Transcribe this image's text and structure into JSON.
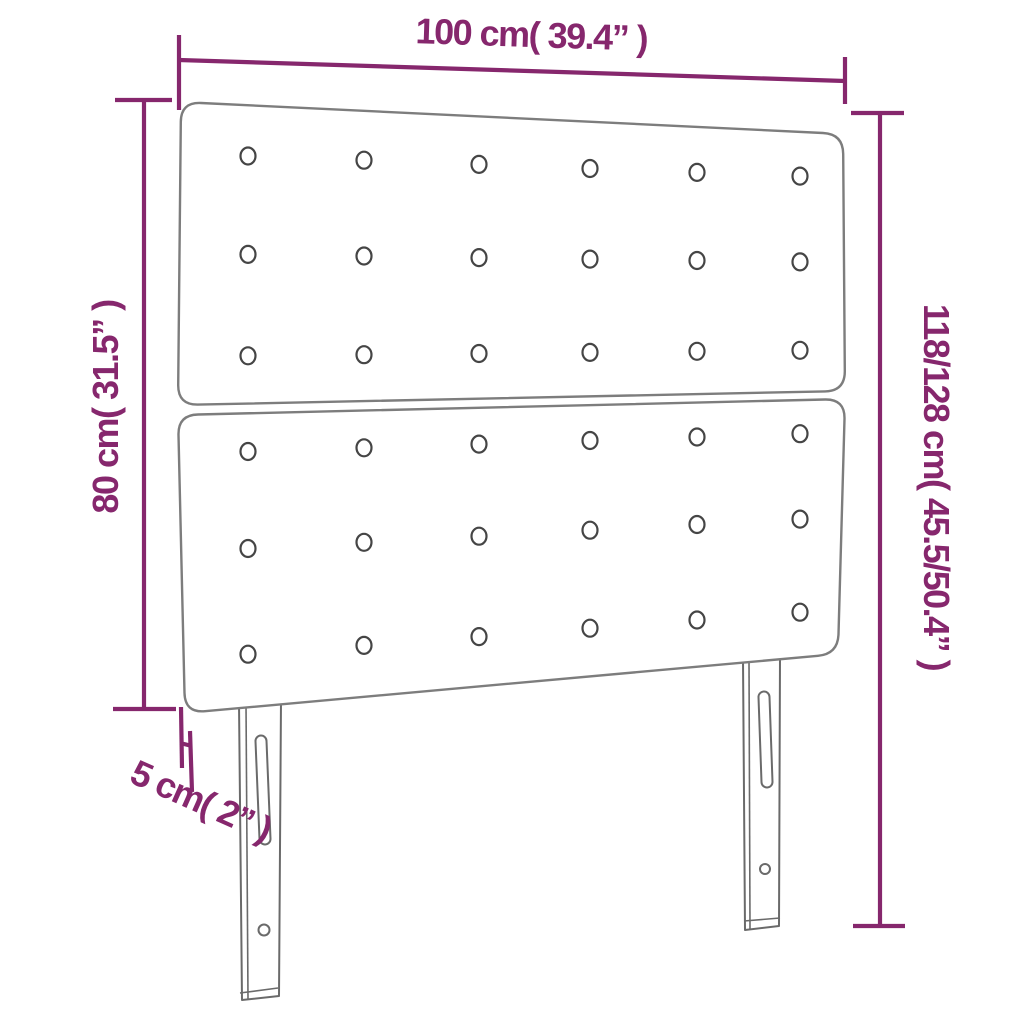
{
  "page": {
    "kind": "product-dimension-diagram",
    "background": "#ffffff"
  },
  "colors": {
    "dimension": "#86276d",
    "panel_outline": "#7d7d7d",
    "leg_outline": "#6a6a6a",
    "button_outline": "#454545"
  },
  "product": {
    "name": "headboard",
    "panel_count": 2,
    "button_rows_per_panel": 3,
    "button_columns": 6,
    "leg_count": 2
  },
  "dimensions": {
    "width": {
      "label": "100 cm( 39.4” )",
      "value_cm": "100",
      "value_in": "39.4"
    },
    "headboard_height": {
      "label": "80 cm( 31.5” )",
      "value_cm": "80",
      "value_in": "31.5"
    },
    "total_height": {
      "label": "118/128 cm( 45.5/50.4” )",
      "value_cm": "118/128",
      "value_in": "45.5/50.4"
    },
    "thickness": {
      "label": "5 cm( 2” )",
      "value_cm": "5",
      "value_in": "2"
    }
  }
}
